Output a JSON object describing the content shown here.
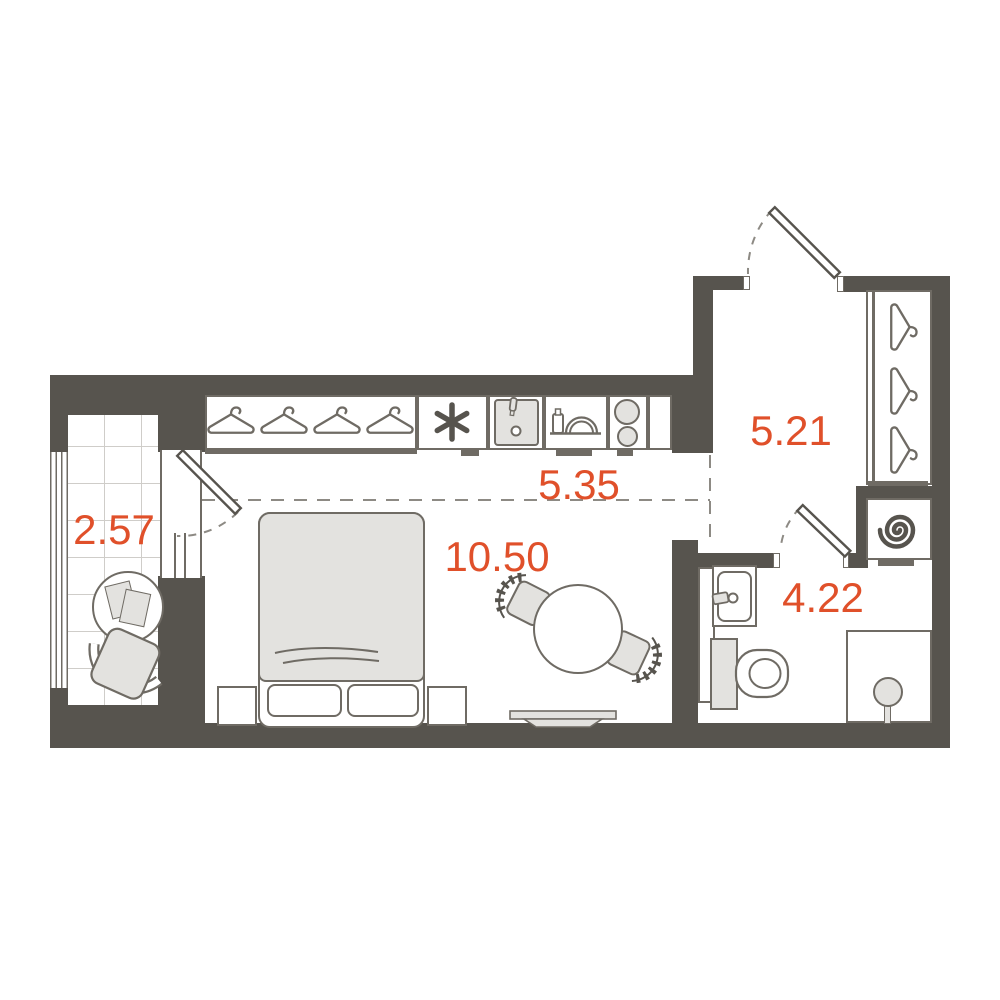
{
  "title": "Studio apartment floor plan",
  "colors": {
    "wall": "#57544e",
    "line": "#6f6b64",
    "fill_light": "#e3e2df",
    "accent": "#e0502a",
    "tile_line": "#cfcdc9",
    "dash": "#8d8a84"
  },
  "rooms": [
    {
      "name": "balcony",
      "area": "2.57"
    },
    {
      "name": "kitchen-zone",
      "area": "5.35"
    },
    {
      "name": "sleeping-zone",
      "area": "10.50"
    },
    {
      "name": "hallway",
      "area": "5.21"
    },
    {
      "name": "bathroom",
      "area": "4.22"
    }
  ],
  "icons": [
    "hanger-icon",
    "snowflake-icon",
    "kitchen-sink-icon",
    "dish-rack-icon",
    "stove-burners-icon",
    "bed-icon",
    "pillow-icon",
    "nightstand-icon",
    "dining-table-icon",
    "chair-icon",
    "tv-icon",
    "balcony-table-icon",
    "armchair-icon",
    "door-leaf-icon",
    "door-swing-arc",
    "washing-machine-icon",
    "toilet-icon",
    "washbasin-icon",
    "shower-icon"
  ]
}
